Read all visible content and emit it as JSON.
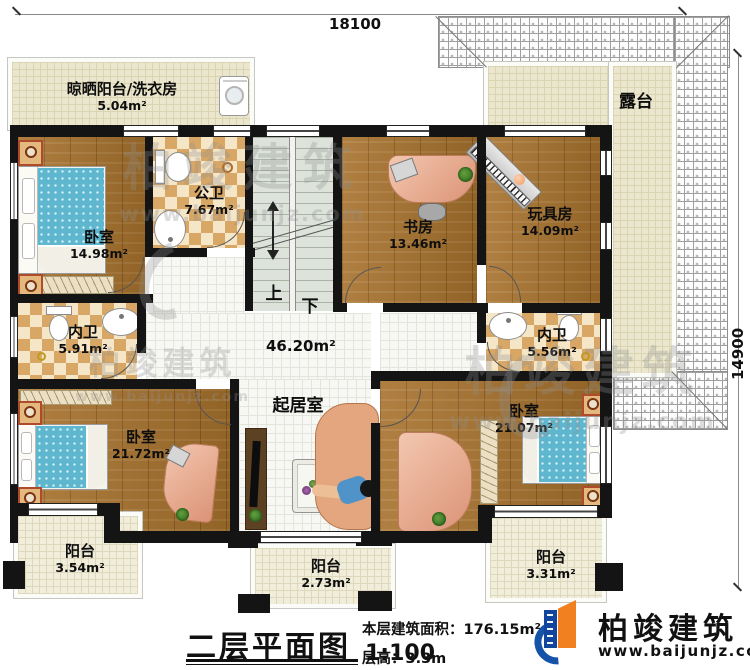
{
  "dimensions": {
    "top": "18100",
    "right": "14900"
  },
  "rooms": {
    "laundry": {
      "label": "晾晒阳台/洗衣房",
      "area": "5.04m²"
    },
    "terrace": {
      "label": "露台"
    },
    "bedroom_nw": {
      "label": "卧室",
      "area": "14.98m²"
    },
    "public_bath": {
      "label": "公卫",
      "area": "7.67m²"
    },
    "study": {
      "label": "书房",
      "area": "13.46m²"
    },
    "toy_room": {
      "label": "玩具房",
      "area": "14.09m²"
    },
    "ensuite_w": {
      "label": "内卫",
      "area": "5.91m²"
    },
    "ensuite_e": {
      "label": "内卫",
      "area": "5.56m²"
    },
    "hall": {
      "area": "46.20m²"
    },
    "living": {
      "label": "起居室"
    },
    "bedroom_sw": {
      "label": "卧室",
      "area": "21.72m²"
    },
    "bedroom_se": {
      "label": "卧室",
      "area": "21.07m²"
    },
    "balcony_sw": {
      "label": "阳台",
      "area": "3.54m²"
    },
    "balcony_s": {
      "label": "阳台",
      "area": "2.73m²"
    },
    "balcony_se": {
      "label": "阳台",
      "area": "3.31m²"
    }
  },
  "stairs": {
    "up": "上",
    "down": "下"
  },
  "title_block": {
    "title": "二层平面图",
    "scale": "1:100",
    "area_label": "本层建筑面积：",
    "area_value": "176.15m²",
    "height_label": "层高：",
    "height_value": "3.3m"
  },
  "logo": {
    "name": "柏竣建筑",
    "website": "www.baijunjz.com"
  },
  "watermark": {
    "name": "柏竣建筑",
    "website": "www.baijunjz.com"
  }
}
